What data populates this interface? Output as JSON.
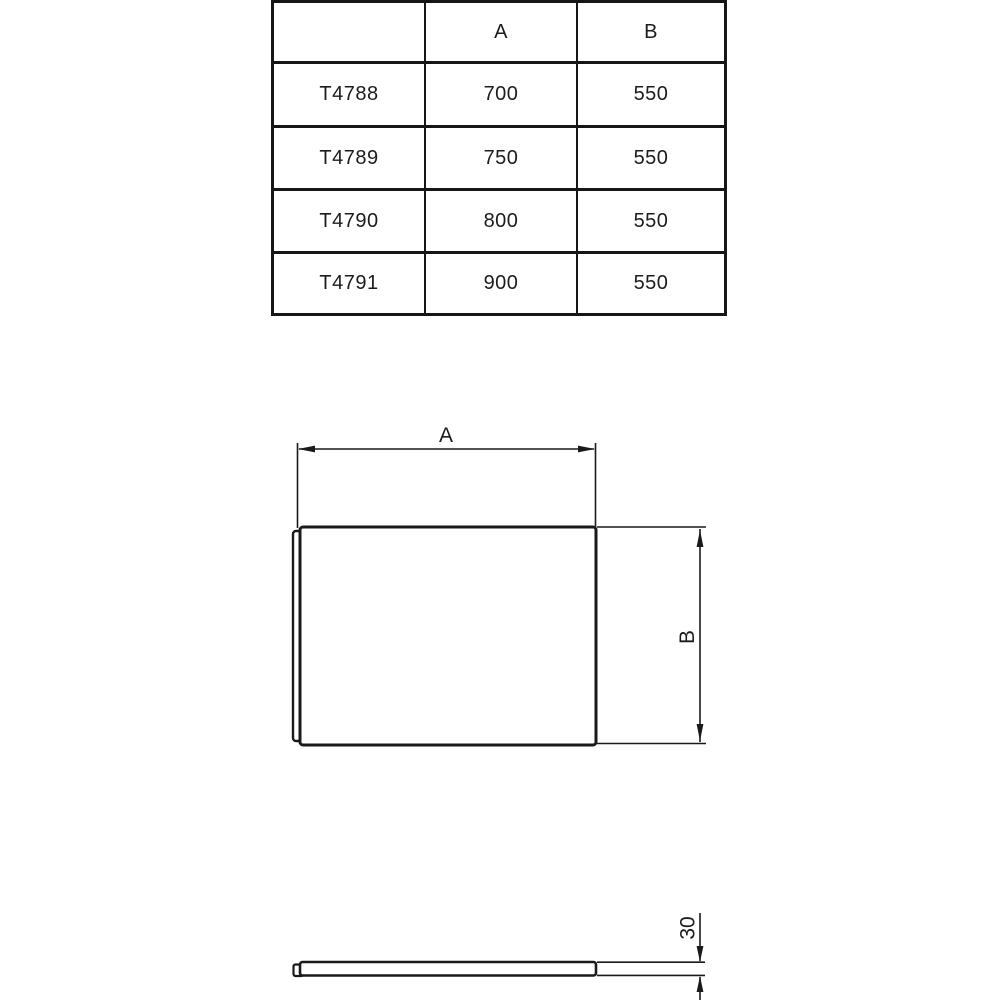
{
  "colors": {
    "background": "#ffffff",
    "line": "#1a1a1a",
    "table_border": "#161616"
  },
  "table": {
    "headers": {
      "col0": "",
      "col1": "A",
      "col2": "B"
    },
    "rows": [
      {
        "code": "T4788",
        "a": "700",
        "b": "550"
      },
      {
        "code": "T4789",
        "a": "750",
        "b": "550"
      },
      {
        "code": "T4790",
        "a": "800",
        "b": "550"
      },
      {
        "code": "T4791",
        "a": "900",
        "b": "550"
      }
    ]
  },
  "front_view": {
    "width_label": "A",
    "height_label": "B"
  },
  "side_view": {
    "thickness_label": "30"
  }
}
